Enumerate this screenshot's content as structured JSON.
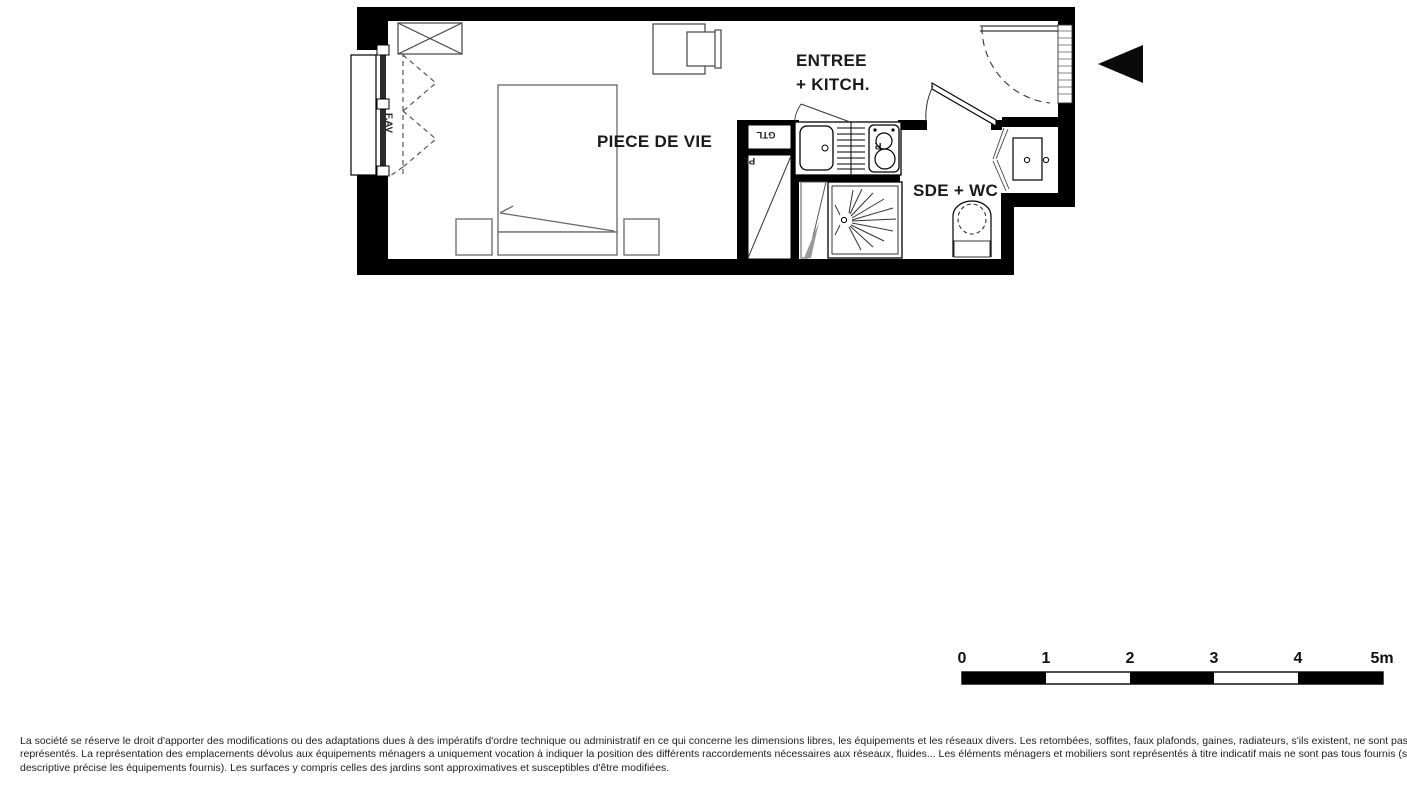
{
  "colors": {
    "wall": "#000000",
    "ink": "#1a1a1a",
    "furniture": "#666666",
    "fixture": "#333333",
    "door_shadow": "#9a9a9a"
  },
  "plan": {
    "labels": {
      "living_room": "PIECE DE VIE",
      "entry_line1": "ENTREE",
      "entry_line2": "+ KITCH.",
      "bathroom": "SDE + WC",
      "technical_duct": "GTL",
      "closet": "PL",
      "fridge": "R",
      "window": "F.AV"
    }
  },
  "scale_bar": {
    "ticks": [
      "0",
      "1",
      "2",
      "3",
      "4",
      "5m"
    ]
  },
  "disclaimer": {
    "line1": "La société se réserve le droit d'apporter des modifications ou des adaptations dues à des impératifs d'ordre technique ou administratif en ce qui concerne les dimensions libres, les équipements et les réseaux divers. Les retombées, soffites, faux plafonds, gaines, radiateurs, s'ils existent, ne sont pas tous",
    "line2": "représentés. La représentation des emplacements dévolus aux équipements ménagers a uniquement vocation à indiquer la position des différents raccordements nécessaires aux réseaux, fluides... Les éléments ménagers et mobiliers sont représentés à titre indicatif mais ne sont pas tous fournis (seule la notice",
    "line3": "descriptive précise les équipements fournis). Les surfaces y compris celles des jardins sont approximatives et susceptibles d'être modifiées."
  }
}
